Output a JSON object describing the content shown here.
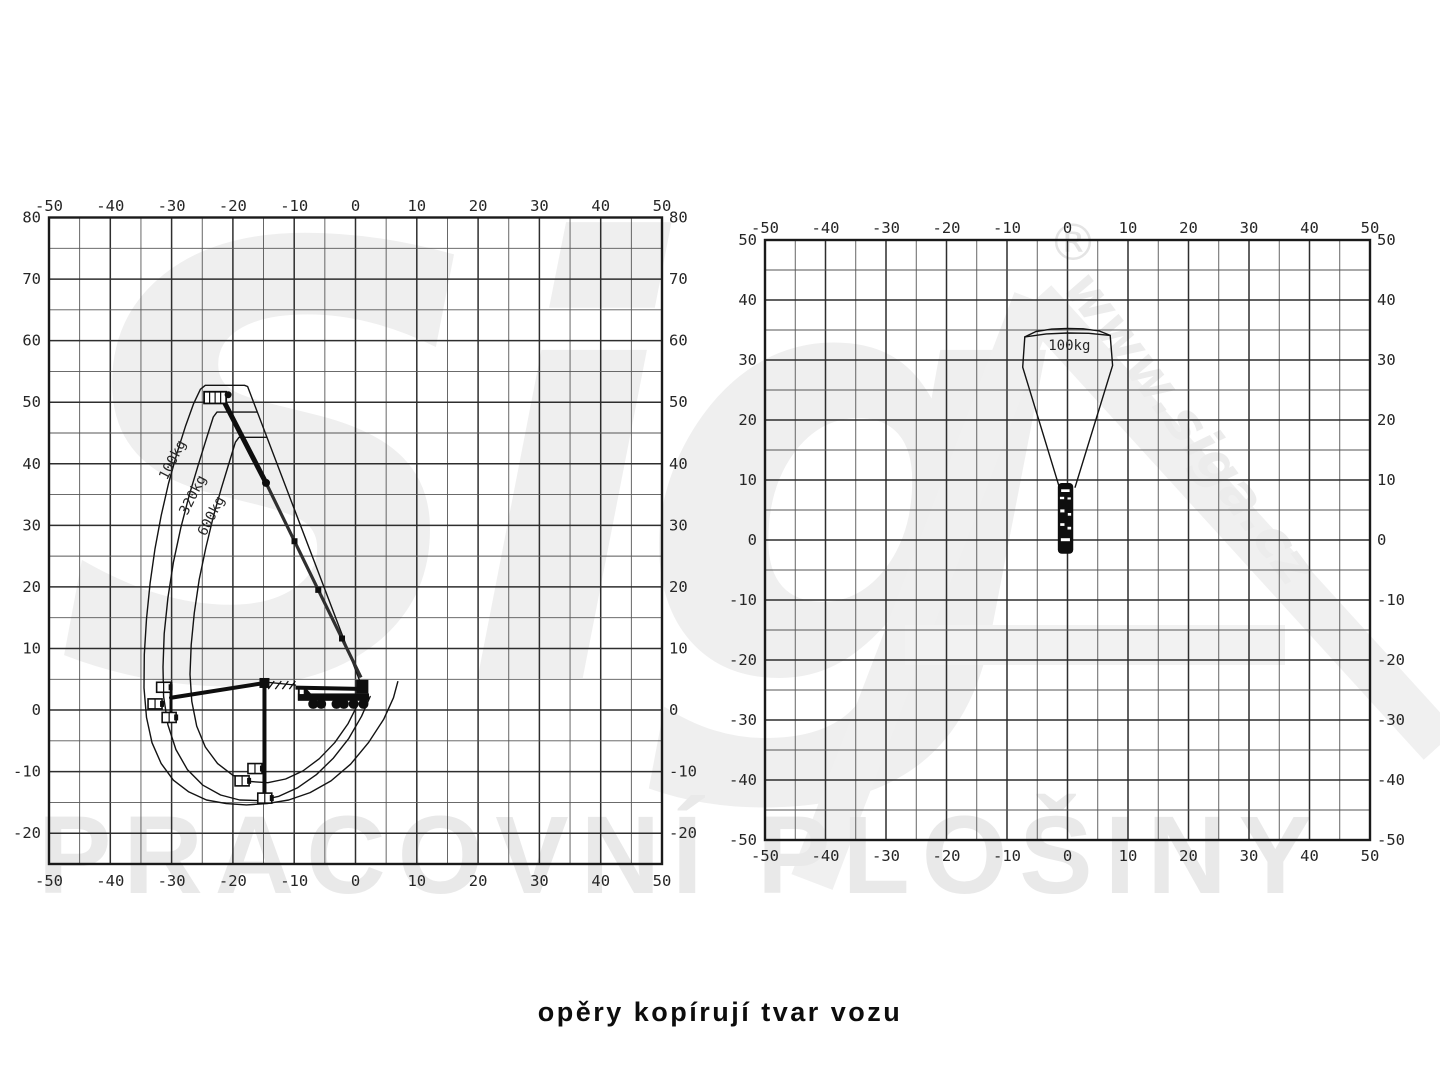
{
  "caption": {
    "text": "opěry kopírují tvar vozu"
  },
  "watermark": {
    "logo_text": "Sig",
    "bottom_text": "PRACOVNÍ PLOŠINY",
    "url_text": "www.siga.cz",
    "registered_mark": "®"
  },
  "colors": {
    "background": "#ffffff",
    "grid_minor": "#565656",
    "grid_major": "#2e2e2e",
    "border": "#1a1a1a",
    "curve": "#131313",
    "label": "#262626",
    "vehicle": "#0e0e0e",
    "watermark": "#eeeeee"
  },
  "chart_data": [
    {
      "id": "side-view",
      "type": "line",
      "title": "working envelope - side view (outreach m vs height m)",
      "xlabel": "outreach (m)",
      "ylabel": "height (m)",
      "x_range": [
        -50,
        50
      ],
      "y_range": [
        -25,
        80
      ],
      "grid_step": 5,
      "grid": true,
      "x_ticks": [
        -50,
        -40,
        -30,
        -20,
        -10,
        0,
        10,
        20,
        30,
        40,
        50
      ],
      "y_ticks": [
        80,
        70,
        60,
        50,
        40,
        30,
        20,
        10,
        0,
        -10,
        -20
      ],
      "series": [
        {
          "name": "100kg",
          "points": [
            [
              0.9,
              4.2
            ],
            [
              -17.6,
              52.55
            ],
            [
              -18.1,
              52.75
            ],
            [
              -24.5,
              52.75
            ],
            [
              -25.3,
              52.1
            ],
            [
              -26.4,
              49.8
            ],
            [
              -27.7,
              46.2
            ],
            [
              -29.1,
              41.8
            ],
            [
              -30.5,
              36.8
            ],
            [
              -31.7,
              31.6
            ],
            [
              -32.7,
              26.2
            ],
            [
              -33.5,
              20.6
            ],
            [
              -34.1,
              14.8
            ],
            [
              -34.45,
              9.0
            ],
            [
              -34.5,
              3.6
            ],
            [
              -34.1,
              -1.2
            ],
            [
              -33.2,
              -5.3
            ],
            [
              -31.7,
              -8.7
            ],
            [
              -29.7,
              -11.4
            ],
            [
              -27.2,
              -13.3
            ],
            [
              -24.3,
              -14.6
            ],
            [
              -21.1,
              -15.2
            ],
            [
              -17.8,
              -15.4
            ],
            [
              -14.4,
              -15.2
            ],
            [
              -10.9,
              -14.6
            ],
            [
              -7.4,
              -13.4
            ],
            [
              -4.0,
              -11.5
            ],
            [
              -0.8,
              -8.8
            ],
            [
              2.1,
              -5.3
            ],
            [
              4.6,
              -1.5
            ],
            [
              6.2,
              2.0
            ],
            [
              6.9,
              4.6
            ]
          ]
        },
        {
          "name": "320kg",
          "points": [
            [
              -16.1,
              48.4
            ],
            [
              -22.6,
              48.4
            ],
            [
              -23.2,
              47.6
            ],
            [
              -24.2,
              44.5
            ],
            [
              -25.6,
              40.0
            ],
            [
              -27.1,
              35.0
            ],
            [
              -28.5,
              29.6
            ],
            [
              -29.7,
              24.0
            ],
            [
              -30.6,
              18.2
            ],
            [
              -31.2,
              12.4
            ],
            [
              -31.4,
              7.0
            ],
            [
              -31.3,
              2.2
            ],
            [
              -30.6,
              -2.4
            ],
            [
              -29.3,
              -6.4
            ],
            [
              -27.4,
              -9.7
            ],
            [
              -24.9,
              -12.2
            ],
            [
              -22.0,
              -13.8
            ],
            [
              -18.9,
              -14.6
            ],
            [
              -15.7,
              -14.7
            ],
            [
              -12.5,
              -14.0
            ],
            [
              -9.4,
              -12.6
            ],
            [
              -6.4,
              -10.5
            ],
            [
              -3.6,
              -7.8
            ],
            [
              -1.1,
              -4.6
            ],
            [
              1.0,
              -1.0
            ],
            [
              2.4,
              2.2
            ]
          ]
        },
        {
          "name": "600kg",
          "points": [
            [
              -14.5,
              44.3
            ],
            [
              -19.0,
              44.3
            ],
            [
              -19.6,
              43.5
            ],
            [
              -20.6,
              40.2
            ],
            [
              -21.9,
              36.0
            ],
            [
              -23.2,
              31.4
            ],
            [
              -24.4,
              26.4
            ],
            [
              -25.5,
              21.2
            ],
            [
              -26.3,
              15.8
            ],
            [
              -26.8,
              10.6
            ],
            [
              -27.0,
              5.8
            ],
            [
              -26.7,
              1.4
            ],
            [
              -25.9,
              -2.6
            ],
            [
              -24.5,
              -6.0
            ],
            [
              -22.5,
              -8.7
            ],
            [
              -20.0,
              -10.6
            ],
            [
              -17.2,
              -11.6
            ],
            [
              -14.3,
              -11.8
            ],
            [
              -11.4,
              -11.2
            ],
            [
              -8.6,
              -9.9
            ],
            [
              -5.9,
              -7.9
            ],
            [
              -3.4,
              -5.3
            ],
            [
              -1.2,
              -2.2
            ],
            [
              0.4,
              1.0
            ]
          ]
        }
      ],
      "curve_labels": [
        {
          "text": "100kg",
          "x": -29.2,
          "y": 40.3,
          "angle": -63
        },
        {
          "text": "320kg",
          "x": -25.9,
          "y": 34.6,
          "angle": -63
        },
        {
          "text": "600kg",
          "x": -22.9,
          "y": 31.2,
          "angle": -63
        }
      ],
      "vehicle": {
        "boom_tip": [
          -21.6,
          50.4
        ],
        "boom_elbow": [
          -14.6,
          36.9
        ],
        "boom_base": [
          0.9,
          5.3
        ],
        "platform_box": [
          -24.7,
          51.7,
          3.6,
          1.9
        ],
        "jib_joint": [
          -14.85,
          4.4
        ],
        "jib_bottom": [
          -14.85,
          -13.6
        ],
        "arm_end": [
          -30.1,
          2.0
        ],
        "link_end": [
          -9.7,
          4.05
        ],
        "rail": {
          "x": -30.1,
          "top": 4.6,
          "bottom": -2.0
        },
        "baskets": [
          [
            -31.3,
            3.7
          ],
          [
            -32.7,
            1.0
          ],
          [
            -30.4,
            -1.2
          ],
          [
            -16.4,
            -9.5
          ],
          [
            -18.5,
            -11.5
          ],
          [
            -14.8,
            -14.3
          ]
        ],
        "truck": {
          "x1": -9.4,
          "x2": 2.2
        }
      }
    },
    {
      "id": "top-view",
      "type": "line",
      "title": "working envelope - top view (m)",
      "xlabel": "lateral reach (m)",
      "ylabel": "longitudinal reach (m)",
      "x_range": [
        -50,
        50
      ],
      "y_range": [
        -50,
        50
      ],
      "grid_step": 5,
      "grid": true,
      "x_ticks": [
        -50,
        -40,
        -30,
        -20,
        -10,
        0,
        10,
        20,
        30,
        40,
        50
      ],
      "y_ticks": [
        50,
        40,
        30,
        20,
        10,
        0,
        -10,
        -20,
        -30,
        -40,
        -50
      ],
      "series": [
        {
          "name": "100kg fan",
          "points": [
            [
              -1.35,
              8.8
            ],
            [
              -7.4,
              28.8
            ],
            [
              -7.05,
              33.85
            ],
            [
              -5.2,
              34.75
            ],
            [
              -2.6,
              35.15
            ],
            [
              0,
              35.25
            ],
            [
              2.6,
              35.2
            ],
            [
              5.2,
              34.85
            ],
            [
              7.05,
              34.1
            ],
            [
              7.45,
              29.1
            ],
            [
              1.25,
              8.8
            ]
          ]
        },
        {
          "name": "top inner arc",
          "points": [
            [
              -7.05,
              33.85
            ],
            [
              -3.5,
              34.35
            ],
            [
              0,
              34.5
            ],
            [
              3.5,
              34.45
            ],
            [
              7.05,
              34.1
            ]
          ]
        }
      ],
      "curve_labels": [
        {
          "text": "100kg",
          "x": 0.3,
          "y": 31.7,
          "angle": 0
        }
      ],
      "vehicle": {
        "rect": {
          "x1": -1.6,
          "x2": 0.95,
          "v_top": 9.5,
          "v_bottom": -2.3
        },
        "white_marks": [
          [
            -1.05,
            8.45,
            0.35,
            8.0
          ],
          [
            -1.25,
            7.2,
            -0.55,
            6.8
          ],
          [
            0.0,
            7.1,
            0.55,
            6.75
          ],
          [
            -1.2,
            5.1,
            -0.5,
            4.6
          ],
          [
            0.05,
            4.5,
            0.6,
            4.05
          ],
          [
            -1.2,
            2.8,
            -0.5,
            2.35
          ],
          [
            0.0,
            2.2,
            0.6,
            1.75
          ],
          [
            -1.1,
            0.3,
            0.4,
            -0.2
          ]
        ]
      }
    }
  ]
}
